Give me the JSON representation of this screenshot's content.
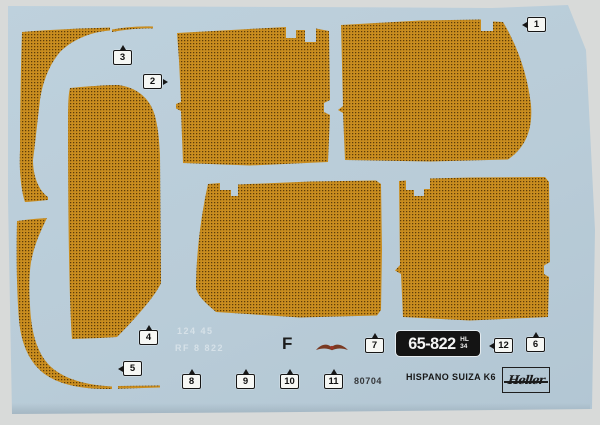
{
  "labels": [
    {
      "num": "1",
      "arrow": "left"
    },
    {
      "num": "2",
      "arrow": "right"
    },
    {
      "num": "3",
      "arrow": "up"
    },
    {
      "num": "4",
      "arrow": "up"
    },
    {
      "num": "5",
      "arrow": "left"
    },
    {
      "num": "6",
      "arrow": "up"
    },
    {
      "num": "7",
      "arrow": "up"
    },
    {
      "num": "8",
      "arrow": "up"
    },
    {
      "num": "9",
      "arrow": "up"
    },
    {
      "num": "10",
      "arrow": "up"
    },
    {
      "num": "11",
      "arrow": "up"
    },
    {
      "num": "12",
      "arrow": "left"
    }
  ],
  "plate": {
    "number": "65-822",
    "suffix_top": "HL",
    "suffix_bottom": "34"
  },
  "texts": {
    "letter": "F",
    "product_code": "80704",
    "model_name": "HISPANO SUIZA K6",
    "brand": "Heller",
    "ghost_line1": "124 45",
    "ghost_line2": "RF 8 822"
  },
  "icons": {
    "stork": "hispano-suiza-wings-emblem"
  },
  "colors": {
    "photo_background": "#d8dad9",
    "sheet_blue": "#b9ccd8",
    "decal_base": "#c98d1f",
    "decal_dot": "#5c3c08",
    "plate_black": "#141414",
    "emblem_brown": "#7a3a22"
  }
}
